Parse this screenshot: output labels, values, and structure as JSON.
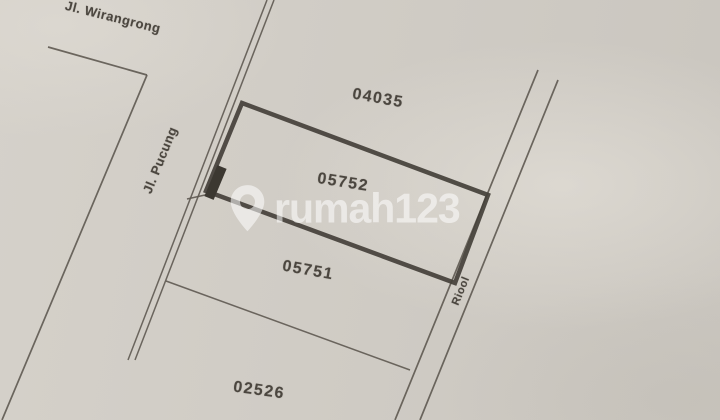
{
  "palette": {
    "paper": "#d0ccc5",
    "thin_line": "#5e5951",
    "bold_line": "#444039",
    "ink_mark": "#3c3831",
    "label_text": "#4b463f",
    "watermark_white": "#ffffff"
  },
  "watermark": {
    "brand_text": "rumah123",
    "icon": "map-pin-icon",
    "opacity": 0.55,
    "x": 226,
    "y": 183,
    "pin_height": 50,
    "font_size": 41
  },
  "parcel_labels": [
    {
      "id": "04035",
      "x": 378,
      "y": 99,
      "rot": 10,
      "size": 16
    },
    {
      "id": "05752",
      "x": 343,
      "y": 183,
      "rot": 9,
      "size": 16
    },
    {
      "id": "05751",
      "x": 308,
      "y": 271,
      "rot": 10,
      "size": 16
    },
    {
      "id": "02526",
      "x": 259,
      "y": 391,
      "rot": 8,
      "size": 16
    }
  ],
  "street_labels": [
    {
      "id": "jl-wirangrong",
      "text": "Jl. Wirangrong",
      "x": 113,
      "y": 17,
      "rot": 14,
      "size": 13
    },
    {
      "id": "jl-pucung",
      "text": "Jl. Pucung",
      "x": 160,
      "y": 160,
      "rot": -68,
      "size": 13
    },
    {
      "id": "riool",
      "text": "Riool",
      "x": 461,
      "y": 291,
      "rot": -68,
      "size": 11
    }
  ],
  "geometry": {
    "lines": [
      {
        "name": "winangrong-street-edge",
        "x1": 48,
        "y1": 47,
        "x2": 147,
        "y2": 75,
        "w": 1.7
      },
      {
        "name": "pucung-west-edge",
        "x1": 147,
        "y1": 75,
        "x2": 2,
        "y2": 420,
        "w": 1.7
      },
      {
        "name": "pucung-east-edge-outer",
        "x1": 267,
        "y1": 0,
        "x2": 128,
        "y2": 360,
        "w": 1.5
      },
      {
        "name": "pucung-east-edge-inner",
        "x1": 274,
        "y1": 0,
        "x2": 135,
        "y2": 360,
        "w": 1.5
      },
      {
        "name": "riool-west-edge",
        "x1": 538,
        "y1": 70,
        "x2": 395,
        "y2": 420,
        "w": 1.7
      },
      {
        "name": "riool-east-edge",
        "x1": 558,
        "y1": 80,
        "x2": 420,
        "y2": 420,
        "w": 1.7
      },
      {
        "name": "parcel-05751-02526-boundary",
        "x1": 166,
        "y1": 281,
        "x2": 410,
        "y2": 370,
        "w": 1.5
      },
      {
        "name": "survey-tick",
        "x1": 187,
        "y1": 199,
        "x2": 214,
        "y2": 193,
        "w": 1.5
      }
    ],
    "highlight_parcel": {
      "name": "parcel-05752-outline",
      "points": "242,103 488,195 455,283 206,191",
      "stroke_width": 4.5
    },
    "frontage_mark": {
      "name": "frontage-ink-mark",
      "x1": 222,
      "y1": 167,
      "x2": 209,
      "y2": 198,
      "w": 10
    }
  }
}
